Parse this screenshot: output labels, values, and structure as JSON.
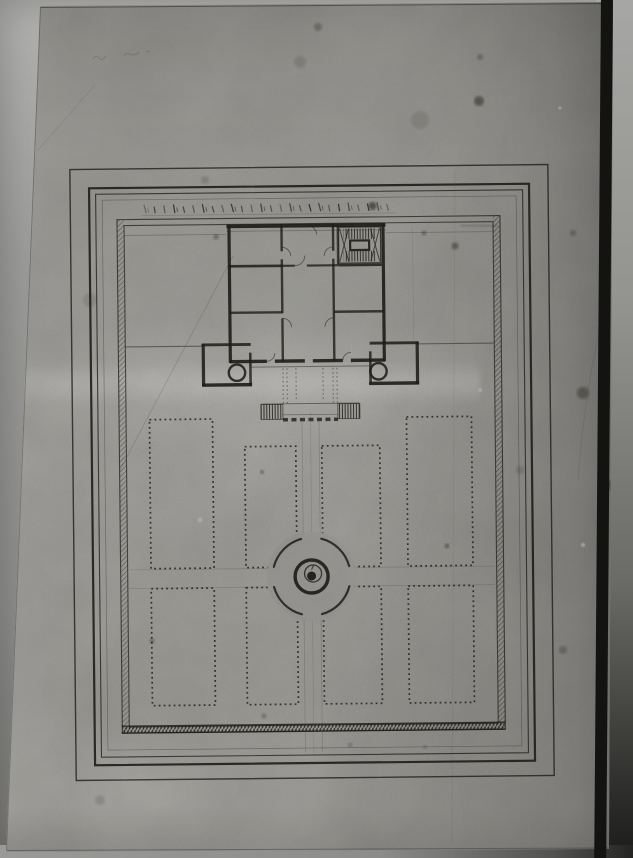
{
  "meta": {
    "content": "photograph of an ink architectural plan: chateau with staircase, two corner pavilions, perron steps, and a formal parterre garden of eight beds around a circular fountain basin; no legible text"
  },
  "palette": {
    "ink": "#26241e",
    "ink_mid": "#3b382f",
    "pencil": "#55504a",
    "paper_mask": "#b1afab",
    "stain": "#2e2a22",
    "speck": "#dcdad6"
  },
  "paper": {
    "corners": "40px 6px, 613px 2px, 609px 849px, 6px 852px"
  },
  "drawing": {
    "tilt": -0.6,
    "frames": [
      [
        73,
        167,
        478,
        611,
        1.4,
        0.8
      ],
      [
        92,
        186,
        440,
        577,
        2.2,
        0.9
      ],
      [
        98.5,
        192,
        427,
        563,
        1.1,
        0.78
      ],
      [
        105,
        198,
        414,
        550,
        0.7,
        0.38
      ]
    ],
    "enclosure": {
      "outer": [
        119.6,
        217.6,
        383,
        513.5
      ],
      "inner": [
        126.6,
        223.6,
        369,
        501.5
      ],
      "hatch_left": [
        119.6,
        218,
        7,
        513
      ],
      "hatch_right": [
        495.4,
        218,
        7,
        513
      ],
      "hatch_bottom": [
        120,
        724.8,
        382,
        6.2
      ],
      "bottom_lines": [
        724.2,
        731.2
      ],
      "smudges": [
        [
          499,
          196,
          499,
          470,
          3.5,
          0.2
        ],
        [
          463,
          226.5,
          500,
          228.5,
          2.5,
          0.2
        ]
      ]
    },
    "scale_bar": {
      "x0": 147,
      "dx": 9.7,
      "count": 26,
      "y_top": 203,
      "y_bot": 211.5,
      "baseline_y": 213.8,
      "x_end": 399
    },
    "walls_h": [
      [
        229,
        225.5,
        388,
        3.8,
        0.92
      ],
      [
        229,
        230.5,
        388,
        0.9,
        0.3
      ],
      [
        231,
        265.5,
        284,
        2.6,
        0.85
      ],
      [
        284,
        265.5,
        297,
        2.2,
        0.8
      ],
      [
        309,
        265.5,
        341,
        2.2,
        0.8
      ],
      [
        341,
        265.5,
        384,
        2.6,
        0.85
      ],
      [
        231,
        312,
        284,
        2.4,
        0.8
      ],
      [
        336,
        312,
        386,
        2.4,
        0.8
      ],
      [
        231,
        360.8,
        268,
        3.4,
        0.9
      ],
      [
        276,
        360.8,
        306,
        3.4,
        0.9
      ],
      [
        314,
        360.8,
        344,
        3.4,
        0.9
      ],
      [
        352,
        360.8,
        386,
        3.4,
        0.9
      ],
      [
        203,
        343.8,
        252,
        2.8,
        0.85
      ],
      [
        203,
        384,
        253,
        3.4,
        0.9
      ],
      [
        371,
        343.8,
        420,
        2.8,
        0.85
      ],
      [
        370,
        384,
        420,
        3.4,
        0.9
      ],
      [
        127,
        345,
        203,
        1.1,
        0.5
      ],
      [
        420,
        345,
        495,
        1.1,
        0.5
      ],
      [
        252,
        366.5,
        371,
        1.0,
        0.45
      ],
      [
        262,
        403.5,
        360,
        0.9,
        0.5
      ],
      [
        127,
        233.5,
        229,
        0.8,
        0.3
      ],
      [
        388,
        233.5,
        495,
        0.8,
        0.3
      ]
    ],
    "walls_v": [
      [
        231.5,
        224,
        362,
        3.2,
        0.9
      ],
      [
        385.5,
        224,
        362,
        3.2,
        0.9
      ],
      [
        284,
        224,
        251,
        2.4,
        0.8
      ],
      [
        284,
        259,
        313,
        2.4,
        0.8
      ],
      [
        284,
        318,
        361,
        2.4,
        0.8
      ],
      [
        335.5,
        224,
        251,
        2.4,
        0.8
      ],
      [
        335.5,
        259,
        361,
        2.4,
        0.8
      ],
      [
        340,
        226,
        265,
        1.8,
        0.75
      ],
      [
        204.5,
        343,
        385,
        3.2,
        0.88
      ],
      [
        251.5,
        352,
        385,
        2.6,
        0.8
      ],
      [
        371.5,
        352,
        385,
        2.6,
        0.8
      ],
      [
        418.5,
        343,
        385,
        3.2,
        0.88
      ]
    ],
    "stair": {
      "box": [
        341,
        227.5,
        42,
        36
      ],
      "strips": [
        [
          346,
          229,
          32,
          10.5
        ],
        [
          346,
          251.5,
          32,
          10.5
        ]
      ],
      "core": [
        352.5,
        241,
        19,
        9.5
      ],
      "x_lines": [
        [
          342,
          229,
          351,
          262
        ],
        [
          351,
          229,
          342,
          262
        ],
        [
          373,
          229,
          382,
          262
        ],
        [
          382,
          229,
          373,
          262
        ]
      ]
    },
    "door_arcs": [
      "M284,247 A9 9 0 0 1 293,256",
      "M335.5,247 A9 9 0 0 0 326.5,256",
      "M297,265.5 A10 10 0 0 0 307,255.5",
      "M284,318 A9 9 0 0 1 293,327",
      "M335.5,318 A9 9 0 0 0 326.5,327",
      "M268,360.8 A8 8 0 0 0 276,352.8",
      "M344,360.8 A8 8 0 0 1 352,352.8",
      "M310,225.5 A9 9 0 0 1 319,234.5"
    ],
    "pavilion_circles": [
      [
        238,
        372,
        8.2
      ],
      [
        379.5,
        372,
        8.2
      ]
    ],
    "perron": {
      "flights": [
        [
          261.5,
          404,
          22,
          15
        ],
        [
          338.5,
          404,
          22,
          15
        ]
      ],
      "platform_dash": [
        283.5,
        419.5,
        338.5
      ],
      "platform_thin": [
        283.5,
        414.5,
        338.5
      ],
      "dotted_v": [
        [
          284,
          368,
          403
        ],
        [
          288,
          368,
          403
        ],
        [
          334,
          368,
          403
        ],
        [
          338,
          368,
          403
        ],
        [
          297,
          368,
          401
        ],
        [
          324,
          368,
          401
        ]
      ]
    },
    "beds": [
      [
        150,
        418,
        63,
        149
      ],
      [
        245,
        446,
        51,
        121
      ],
      [
        322,
        446,
        58,
        121
      ],
      [
        407,
        418,
        65,
        149
      ],
      [
        150,
        587,
        63,
        117
      ],
      [
        245,
        587,
        51,
        117
      ],
      [
        322,
        587,
        58,
        117
      ],
      [
        407,
        587,
        65,
        117
      ]
    ],
    "fountain": {
      "cx": 310.5,
      "cy": 576.5,
      "r_outer": 39,
      "r_ring": 16.5,
      "r_inner": 8.5,
      "r_dot": 4.5,
      "arc_start": 15,
      "arc_end": 75,
      "mask_r": 45
    },
    "pencil_v": [
      [
        302.5,
        420,
        752,
        0.7,
        0.3
      ],
      [
        311,
        412,
        756,
        0.6,
        0.25
      ],
      [
        319.5,
        420,
        752,
        0.7,
        0.3
      ],
      [
        415,
        228,
        342,
        0.6,
        0.18
      ]
    ],
    "pencil_h": [
      [
        128,
        568,
        494,
        0.7,
        0.28
      ],
      [
        128,
        586.5,
        494,
        0.7,
        0.28
      ]
    ],
    "creases": [
      [
        "M120,470 L233,256",
        0.22
      ],
      [
        "M38,150 L95,85",
        0.14
      ],
      [
        "M600,330 q-15,60 -22,150",
        0.18
      ],
      [
        "M455,170 L452,845",
        0.1
      ]
    ],
    "squiggles": [
      "M93,59 q3,-5 6,-1 q3,4 7,-2",
      "M124,56 q2,-4 5,-2 t6,0 q2,1 4,-2",
      "M146,53 q2,-3 4,-1"
    ],
    "paper_edges": [
      [
        41,
        7.5,
        611,
        3.5,
        1,
        0.5
      ],
      [
        7,
        850.5,
        608,
        848,
        1,
        0.35
      ],
      [
        40.5,
        7,
        6.5,
        850,
        0.9,
        0.3
      ]
    ],
    "stains": [
      [
        479,
        101,
        5,
        0.5
      ],
      [
        455,
        246,
        3.5,
        0.45
      ],
      [
        424,
        233,
        2.4,
        0.4
      ],
      [
        372.5,
        206,
        4,
        0.6
      ],
      [
        583,
        393,
        6,
        0.4
      ],
      [
        447,
        546,
        2.4,
        0.45
      ],
      [
        262,
        472,
        2,
        0.45
      ],
      [
        216,
        237,
        2.6,
        0.4
      ],
      [
        152,
        641,
        2.4,
        0.4
      ],
      [
        264,
        716,
        2.6,
        0.3
      ],
      [
        480,
        57,
        3,
        0.3
      ],
      [
        318,
        27,
        4,
        0.3
      ],
      [
        563,
        650,
        4,
        0.28
      ],
      [
        420,
        120,
        9,
        0.12
      ],
      [
        300,
        62,
        6,
        0.14
      ],
      [
        90,
        300,
        7,
        0.13
      ],
      [
        205,
        180,
        4,
        0.18
      ],
      [
        520,
        470,
        4,
        0.18
      ],
      [
        573,
        233,
        3,
        0.3
      ],
      [
        609,
        485,
        5,
        0.35
      ],
      [
        100,
        800,
        5,
        0.15
      ],
      [
        350,
        745,
        2.2,
        0.3
      ],
      [
        425,
        747,
        2,
        0.28
      ]
    ],
    "white_specks": [
      [
        583,
        545,
        2.2
      ],
      [
        560,
        108,
        1.6
      ],
      [
        480,
        390,
        2
      ],
      [
        200,
        520,
        2.5
      ]
    ]
  }
}
